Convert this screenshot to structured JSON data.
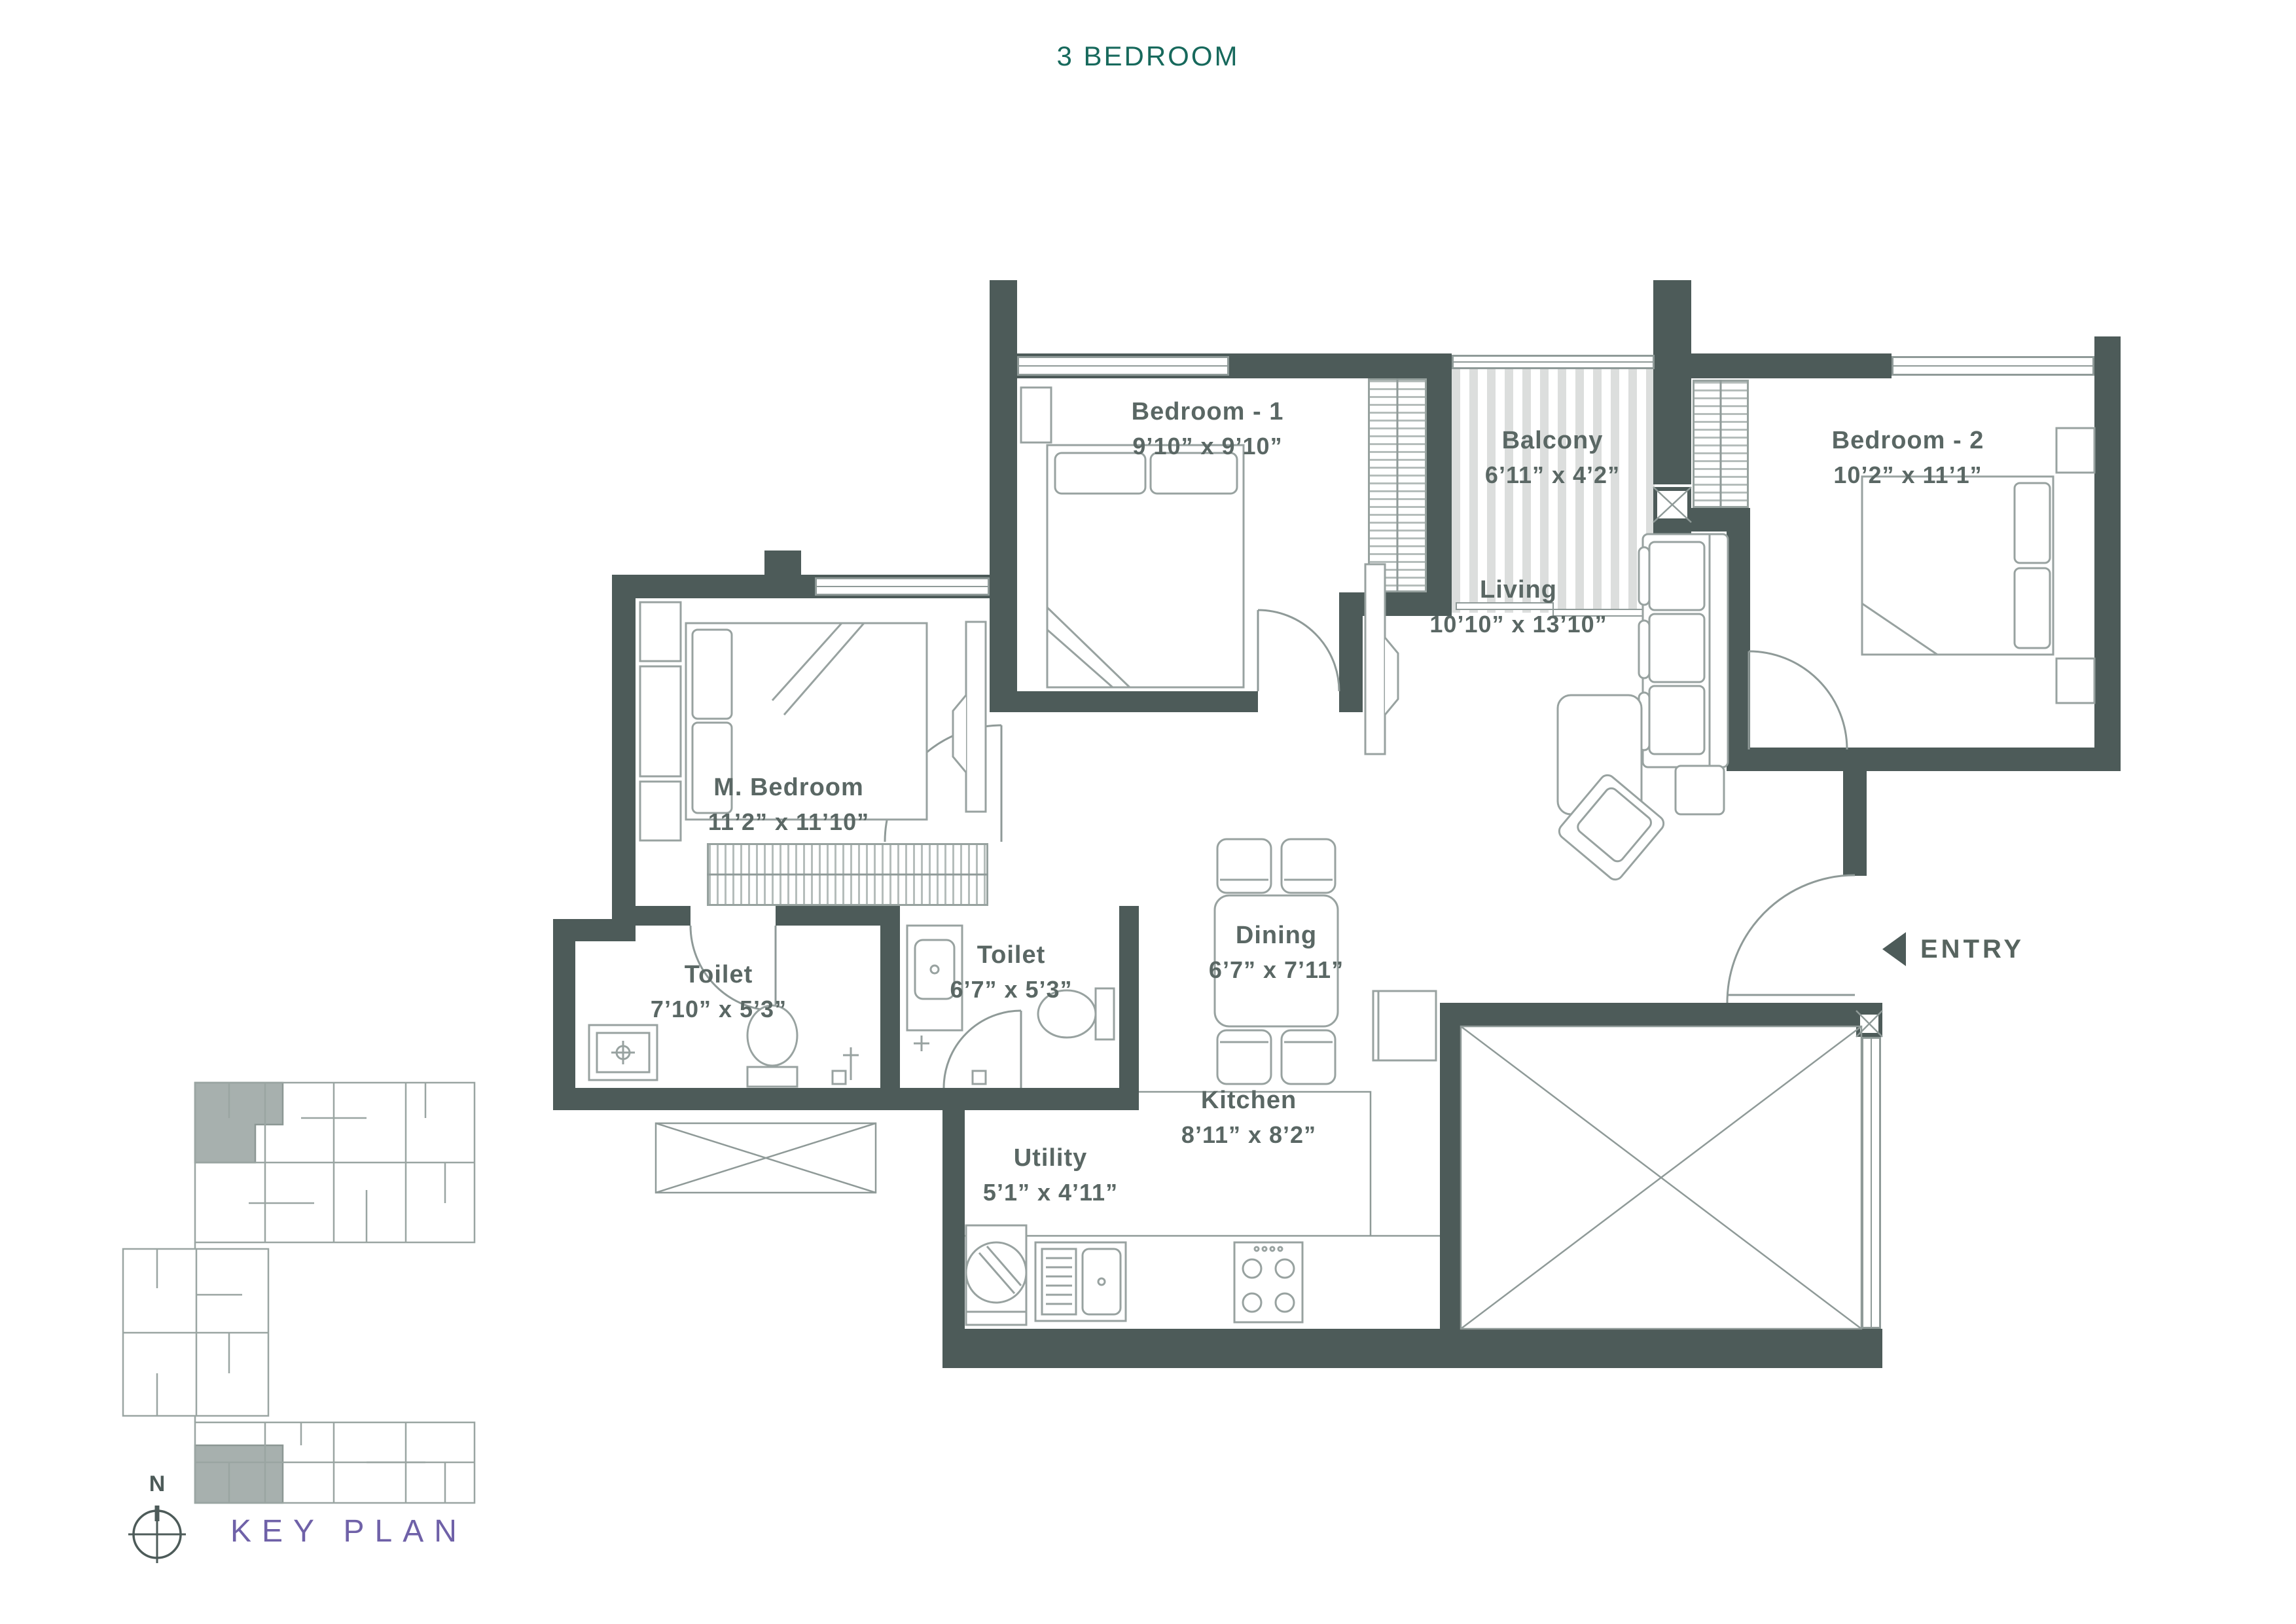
{
  "title": "3 BEDROOM",
  "plan": {
    "rooms": [
      {
        "id": "bedroom-1",
        "name": "Bedroom - 1",
        "dims": "9’10” x 9’10”"
      },
      {
        "id": "balcony",
        "name": "Balcony",
        "dims": "6’11” x 4’2”"
      },
      {
        "id": "bedroom-2",
        "name": "Bedroom - 2",
        "dims": "10’2” x 11’1”"
      },
      {
        "id": "living",
        "name": "Living",
        "dims": "10’10”  x 13’10”"
      },
      {
        "id": "m-bedroom",
        "name": "M. Bedroom",
        "dims": "11’2” x 11’10”"
      },
      {
        "id": "dining",
        "name": "Dining",
        "dims": "6’7” x 7’11”"
      },
      {
        "id": "toilet-1",
        "name": "Toilet",
        "dims": "7’10” x 5’3”"
      },
      {
        "id": "toilet-2",
        "name": "Toilet",
        "dims": "6’7” x 5’3”"
      },
      {
        "id": "kitchen",
        "name": "Kitchen",
        "dims": "8’11” x 8’2”"
      },
      {
        "id": "utility",
        "name": "Utility",
        "dims": "5’1” x 4’11”"
      }
    ],
    "entry": {
      "label": "ENTRY"
    }
  },
  "key_plan": {
    "label": "KEY PLAN",
    "north": "N"
  },
  "colors": {
    "wall": "#4d5b59",
    "furniture_line": "#929d9a",
    "room_text": "#5a6764",
    "title_teal": "#17695c",
    "keyplan_purple": "#6f61a8",
    "balcony_stripe": "#dcdedd",
    "keyplan_highlight": "#a7b0ae"
  },
  "icons": {
    "entry_arrow": "left-triangle",
    "compass": "north-compass"
  }
}
